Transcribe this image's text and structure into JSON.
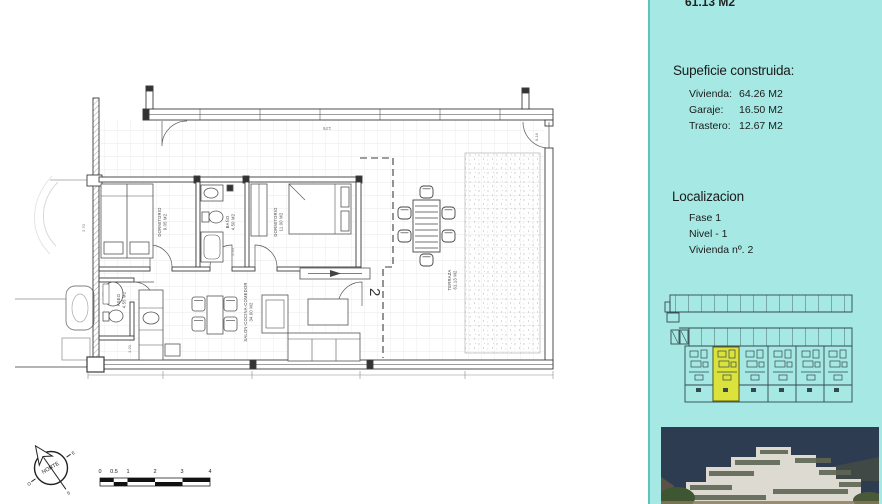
{
  "colors": {
    "sidebar_bg": "#a6e8e4",
    "sidebar_border": "#5bc4c0",
    "highlight_unit": "#dce23c",
    "photo_sky": "#2e3c52",
    "plan_line": "#3c3c3c"
  },
  "sidebar": {
    "top_area_value": "61.13 M2",
    "surface": {
      "heading": "Supeficie construida:",
      "items": [
        {
          "label": "Vivienda:",
          "value": "64.26 M2"
        },
        {
          "label": "Garaje:",
          "value": "16.50 M2"
        },
        {
          "label": "Trastero:",
          "value": "12.67 M2"
        }
      ]
    },
    "location": {
      "heading": "Localizacion",
      "items": [
        "Fase 1",
        "Nivel - 1",
        "Vivienda nº. 2"
      ]
    }
  },
  "plan": {
    "rooms": {
      "dormitorio1": {
        "name": "DORMITORIO",
        "area": "9.05 M2"
      },
      "bano": {
        "name": "BAÑO",
        "area": "4.50 M2"
      },
      "dormitorio2": {
        "name": "DORMITORIO",
        "area": "11.00 M2"
      },
      "aseo": {
        "name": "ASEO",
        "area": "4.55 M2"
      },
      "salon": {
        "name": "SALON-COCINA-COMEDOR",
        "area": "34.00 M2"
      },
      "terraza": {
        "name": "TERRAZA",
        "area": "61.13 M2"
      }
    },
    "unit_number": "2",
    "dimensions": {
      "top_width": "13'6",
      "d1": "2.70",
      "d2": "2.20",
      "d3": "3.20",
      "d4": "8.18"
    },
    "compass": {
      "label": "NORTE",
      "east": "E",
      "west": "O",
      "south": "S"
    },
    "scale_ticks": [
      "0",
      "0.5",
      "1",
      "2",
      "3",
      "4"
    ]
  }
}
